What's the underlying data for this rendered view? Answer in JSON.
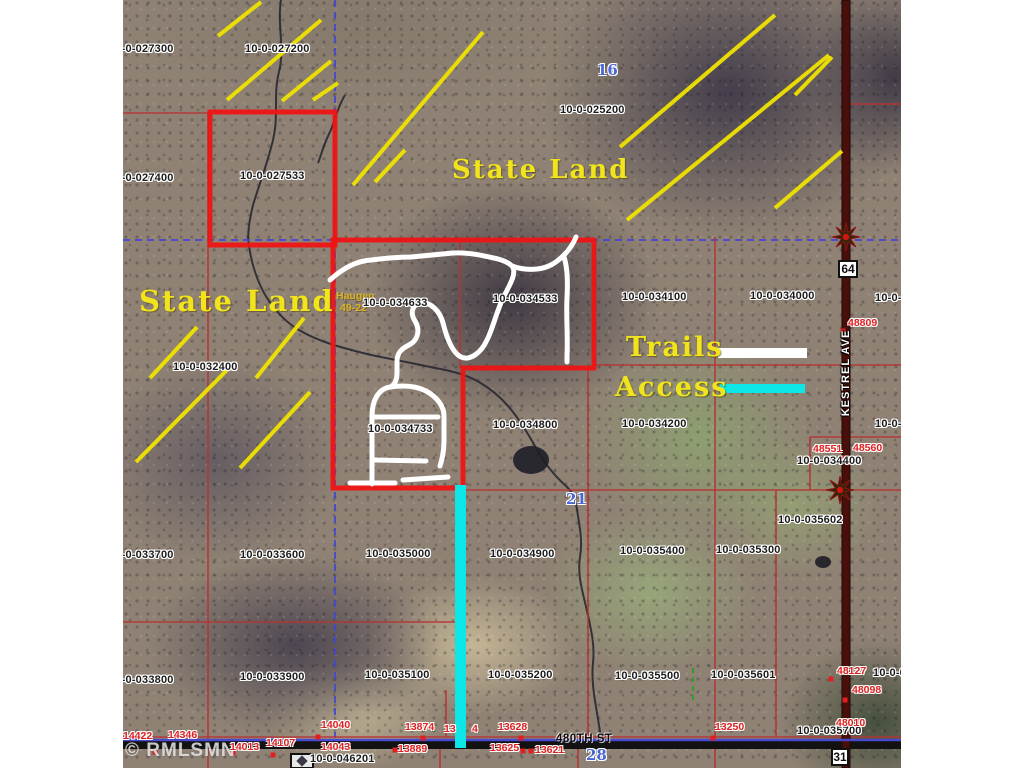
{
  "canvas": {
    "width": 1024,
    "height": 768,
    "bg": "#ffffff"
  },
  "map": {
    "left": 123,
    "top": 0,
    "width": 778,
    "height": 768,
    "colors": {
      "parcel_thin": "#b83232",
      "parcel_thick": "#ee1414",
      "section_blue": "#4747d2",
      "hatch": "#f0e300",
      "trail": "#ffffff",
      "access": "#0ce6e6",
      "creek": "#23232e",
      "road_dark": "#4a0f0a",
      "road_black": "#121212",
      "parcel_label": "#1b1b1b",
      "red_label": "#e02020",
      "blue_label": "#4a66d4",
      "yellow_text": "#f2e41c",
      "wma_text": "#d8b428",
      "dot": "#e02020",
      "pond": "#1e1e28",
      "green_dash": "#2f9e2f"
    },
    "state_land": [
      {
        "text": "State Land",
        "x": 329,
        "y": 155,
        "size": 26
      },
      {
        "text": "State Land",
        "x": 16,
        "y": 284,
        "size": 29
      }
    ],
    "legend": {
      "trails_label": "Trails",
      "access_label": "Access"
    },
    "wma": {
      "line1": "Haugen",
      "line2": "49-22"
    },
    "watermark": "© RMLSMN",
    "roads": {
      "kestrel_label": "KESTREL AVE",
      "street_label": "480TH ST"
    },
    "hwy_boxes": [
      {
        "text": "64",
        "x": 715,
        "y": 260,
        "w": 20,
        "h": 18
      },
      {
        "text": "31",
        "x": 708,
        "y": 748,
        "w": 18,
        "h": 18
      }
    ],
    "blue_numbers": [
      {
        "text": "16",
        "x": 474,
        "y": 63
      },
      {
        "text": "21",
        "x": 443,
        "y": 492
      },
      {
        "text": "28",
        "x": 463,
        "y": 748
      }
    ],
    "parcel_labels": [
      {
        "text": "10-0-027300",
        "x": -14,
        "y": 44
      },
      {
        "text": "10-0-027200",
        "x": 122,
        "y": 44
      },
      {
        "text": "10-0-025200",
        "x": 437,
        "y": 105
      },
      {
        "text": "10-0-027400",
        "x": -14,
        "y": 173
      },
      {
        "text": "10-0-027533",
        "x": 117,
        "y": 171
      },
      {
        "text": "10-0-032400",
        "x": 50,
        "y": 362
      },
      {
        "text": "10-0-034633",
        "x": 240,
        "y": 298
      },
      {
        "text": "10-0-034533",
        "x": 370,
        "y": 294
      },
      {
        "text": "10-0-034100",
        "x": 499,
        "y": 292
      },
      {
        "text": "10-0-034000",
        "x": 627,
        "y": 291
      },
      {
        "text": "10-0-0",
        "x": 752,
        "y": 293
      },
      {
        "text": "10-0-034733",
        "x": 245,
        "y": 424
      },
      {
        "text": "10-0-034800",
        "x": 370,
        "y": 420
      },
      {
        "text": "10-0-034200",
        "x": 499,
        "y": 419
      },
      {
        "text": "10-0-034400",
        "x": 674,
        "y": 456
      },
      {
        "text": "10-0-0",
        "x": 752,
        "y": 419
      },
      {
        "text": "10-0-035602",
        "x": 655,
        "y": 515
      },
      {
        "text": "10-0-033700",
        "x": -14,
        "y": 550
      },
      {
        "text": "10-0-033600",
        "x": 117,
        "y": 550
      },
      {
        "text": "10-0-035000",
        "x": 243,
        "y": 549
      },
      {
        "text": "10-0-034900",
        "x": 367,
        "y": 549
      },
      {
        "text": "10-0-035400",
        "x": 497,
        "y": 546
      },
      {
        "text": "10-0-035300",
        "x": 593,
        "y": 545
      },
      {
        "text": "10-0-033800",
        "x": -14,
        "y": 675
      },
      {
        "text": "10-0-033900",
        "x": 117,
        "y": 672
      },
      {
        "text": "10-0-035100",
        "x": 242,
        "y": 670
      },
      {
        "text": "10-0-035200",
        "x": 365,
        "y": 670
      },
      {
        "text": "10-0-035500",
        "x": 492,
        "y": 671
      },
      {
        "text": "10-0-035601",
        "x": 588,
        "y": 670
      },
      {
        "text": "10-0-0",
        "x": 750,
        "y": 668
      },
      {
        "text": "10-0-035700",
        "x": 674,
        "y": 726
      },
      {
        "text": "10-0-046201",
        "x": 187,
        "y": 754
      }
    ],
    "red_labels": [
      {
        "text": "48809",
        "x": 725,
        "y": 318
      },
      {
        "text": "48551",
        "x": 690,
        "y": 444
      },
      {
        "text": "48560",
        "x": 730,
        "y": 443
      },
      {
        "text": "48127",
        "x": 714,
        "y": 666
      },
      {
        "text": "48098",
        "x": 729,
        "y": 685
      },
      {
        "text": "48010",
        "x": 713,
        "y": 718
      },
      {
        "text": "14422",
        "x": 0,
        "y": 731
      },
      {
        "text": "14346",
        "x": 45,
        "y": 730
      },
      {
        "text": "14013",
        "x": 107,
        "y": 742
      },
      {
        "text": "14107",
        "x": 143,
        "y": 738
      },
      {
        "text": "14040",
        "x": 198,
        "y": 720
      },
      {
        "text": "14043",
        "x": 198,
        "y": 742
      },
      {
        "text": "13874",
        "x": 282,
        "y": 722
      },
      {
        "text": "13",
        "x": 321,
        "y": 724
      },
      {
        "text": "4",
        "x": 349,
        "y": 724
      },
      {
        "text": "13889",
        "x": 275,
        "y": 744
      },
      {
        "text": "13628",
        "x": 375,
        "y": 722
      },
      {
        "text": "13625",
        "x": 367,
        "y": 743
      },
      {
        "text": "13621",
        "x": 412,
        "y": 745
      },
      {
        "text": "13250",
        "x": 592,
        "y": 722
      }
    ],
    "dots": [
      [
        720,
        331
      ],
      [
        195,
        737
      ],
      [
        272,
        750
      ],
      [
        300,
        738
      ],
      [
        398,
        738
      ],
      [
        400,
        751
      ],
      [
        408,
        751
      ],
      [
        590,
        738
      ],
      [
        708,
        679
      ],
      [
        722,
        700
      ],
      [
        720,
        458
      ],
      [
        715,
        733
      ],
      [
        110,
        753
      ],
      [
        150,
        755
      ],
      [
        32,
        752
      ]
    ],
    "hatch_lines": [
      [
        95,
        36,
        138,
        2
      ],
      [
        104,
        100,
        198,
        20
      ],
      [
        159,
        101,
        208,
        61
      ],
      [
        190,
        100,
        215,
        83
      ],
      [
        230,
        185,
        360,
        32
      ],
      [
        252,
        182,
        282,
        150
      ],
      [
        497,
        147,
        652,
        15
      ],
      [
        504,
        220,
        706,
        55
      ],
      [
        652,
        208,
        719,
        151
      ],
      [
        672,
        95,
        709,
        57
      ],
      [
        27,
        378,
        74,
        327
      ],
      [
        133,
        378,
        181,
        318
      ],
      [
        13,
        462,
        105,
        369
      ],
      [
        117,
        468,
        187,
        392
      ]
    ],
    "red_segments": [
      [
        85,
        113,
        85,
        768
      ],
      [
        337,
        243,
        337,
        368
      ],
      [
        465,
        368,
        465,
        737
      ],
      [
        592,
        237,
        592,
        737
      ],
      [
        653,
        490,
        653,
        737
      ],
      [
        323,
        690,
        323,
        737
      ],
      [
        0,
        113,
        87,
        113
      ],
      [
        471,
        365,
        778,
        365
      ],
      [
        687,
        437,
        778,
        437
      ],
      [
        687,
        437,
        687,
        490
      ],
      [
        337,
        490,
        778,
        490
      ],
      [
        0,
        622,
        334,
        622
      ],
      [
        722,
        104,
        778,
        104
      ],
      [
        0,
        737,
        778,
        737
      ],
      [
        455,
        745,
        455,
        768
      ],
      [
        317,
        745,
        317,
        768
      ],
      [
        592,
        745,
        592,
        768
      ]
    ],
    "blue_dashed": [
      [
        212,
        0,
        212,
        738
      ],
      [
        0,
        240,
        778,
        240
      ]
    ],
    "blue_solid": [
      [
        0,
        740,
        778,
        740
      ]
    ],
    "green_dashed": [
      [
        570,
        668,
        570,
        700
      ]
    ],
    "thick_red_outlines": [
      "M87,112 h125 v133 h-125 Z",
      "M210,240 L471,240 L471,368 L340,368 L340,488 L210,488 Z"
    ],
    "trail_paths": [
      "M207,280 C220,268 233,261 248,260 C264,258 274,257 288,257 L330,253 C346,252 362,256 375,259 C382,261 386,263 389,266 C394,272 388,283 381,296 C374,310 370,328 364,340 C358,353 347,361 338,357 C330,353 324,339 320,323 C317,311 307,301 297,303 C289,305 287,313 292,321 C298,331 294,341 286,345 C280,348 274,352 274,361 L274,372 C274,380 272,384 268,387",
      "M389,266 C397,269 405,270 414,269 C425,268 433,263 441,255 C447,249 451,242 453,237",
      "M441,257 C444,266 445,280 444,298 C443,318 445,336 444,355 L444,362",
      "M249,484 L249,416 C249,401 255,389 267,387 C281,385 293,386 303,391 C314,397 321,406 321,416 L321,441 C321,452 319,459 317,466",
      "M252,417 L315,417",
      "M252,460 L303,461",
      "M227,483 L272,483",
      "M280,480 L325,477"
    ],
    "creek_paths": [
      "M158,0 C154,25 162,48 156,72 C150,95 156,115 150,140 C144,165 136,185 130,205 C126,222 124,235 126,245 C128,262 134,282 144,298 C152,310 162,322 176,330 C196,342 220,348 244,354 C266,359 290,363 312,368 C330,371 344,375 356,382 C368,389 380,399 390,412 C400,425 408,439 416,453 C424,467 434,478 444,487 C450,493 452,499 454,509 C456,525 460,539 457,557 C454,575 460,593 464,611 C468,629 472,645 470,663 C468,681 472,701 475,719 C477,731 478,739 480,749",
      "M222,95 C214,108 212,122 206,134 C200,146 198,156 195,163"
    ],
    "ponds": [
      [
        408,
        460,
        18,
        14
      ],
      [
        700,
        562,
        8,
        6
      ]
    ],
    "compasses": [
      [
        723,
        237
      ],
      [
        717,
        490
      ]
    ],
    "legend_bars": {
      "trails": [
        595,
        348,
        89,
        10
      ],
      "access": [
        597,
        384,
        85,
        9
      ]
    },
    "access_line": [
      332,
      485,
      11,
      263
    ],
    "road_rects": {
      "kestrel": [
        719,
        0,
        8,
        768
      ],
      "street": [
        0,
        741,
        778,
        8
      ]
    }
  }
}
